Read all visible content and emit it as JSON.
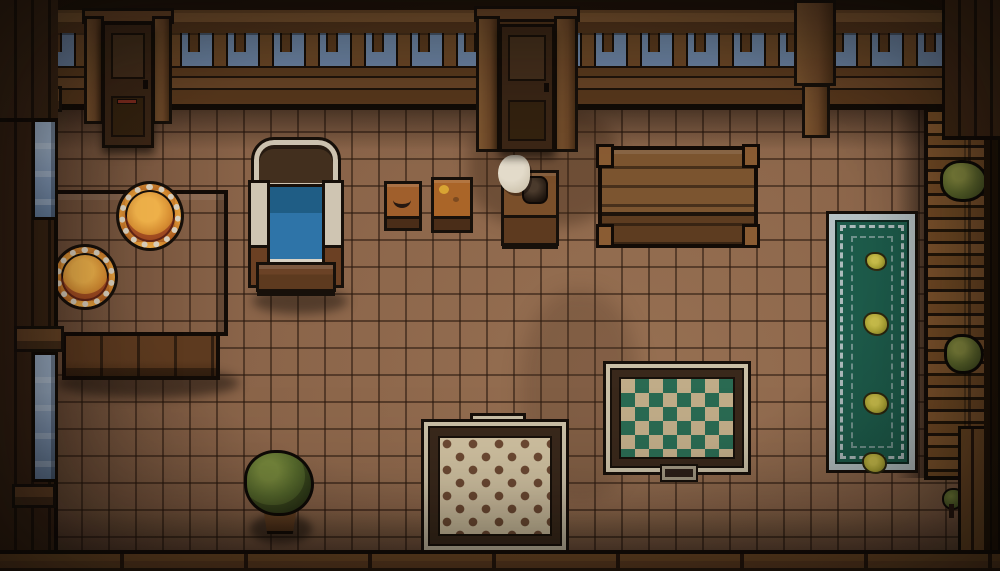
{
  "scene": {
    "title": "pixel-art top-down tavern room interior",
    "viewport": "1000x571"
  },
  "objects": {
    "door_left": {
      "label": "wooden door upper-left"
    },
    "door_center": {
      "label": "wooden door upper-center"
    },
    "bed": {
      "label": "bed with blue blanket and cream frame"
    },
    "dining_table": {
      "label": "wooden dining table"
    },
    "plate_1": {
      "label": "plate with orange food"
    },
    "plate_2": {
      "label": "plate with orange food"
    },
    "crate_1": {
      "label": "small crate table with food item"
    },
    "crate_2": {
      "label": "small crate table with food item"
    },
    "nightstand": {
      "label": "nightstand with dark jug and white cloth"
    },
    "long_table": {
      "label": "large wooden table with corner legs"
    },
    "green_rug": {
      "label": "long green runner rug with four yellow flowers"
    },
    "checkered_rug": {
      "label": "cream rug with brown checkered pattern"
    },
    "diamond_rug": {
      "label": "tan rug with green diamond pattern"
    },
    "potted_plant": {
      "label": "potted green bush"
    },
    "small_plant": {
      "label": "small plant sprite bottom-right"
    },
    "staircase": {
      "label": "wooden staircase along right wall"
    },
    "stair_bush_1": {
      "label": "bush on staircase"
    },
    "stair_bush_2": {
      "label": "bush on staircase"
    },
    "window_upper_left": {
      "label": "tall window upper left wall"
    },
    "window_lower_left": {
      "label": "tall window lower left wall"
    },
    "balustrade": {
      "label": "railing with sky visible behind"
    },
    "tile_floor": {
      "label": "brown tile floor"
    }
  },
  "palette": {
    "outline": "#17100a",
    "wall-plank": "#3a2414",
    "wall-plank-dark": "#1d120a",
    "beam": "#6b4627",
    "beam-light": "#7d5630",
    "beam-dark": "#54361c",
    "sky": "#7089aa",
    "glass": "#8ca4c6",
    "door": "#3b2616",
    "door-panel": "#46301d",
    "floor": "#8a6449",
    "table-wood": "#6e4a28",
    "plate-rim": "#d9cfbc",
    "food": "#d88f33",
    "food-dark": "#9c4a17",
    "bed-cream": "#cfc5b2",
    "bed-blue": "#2e74a8",
    "bed-blue-dark": "#1f5d85",
    "bed-wood": "#5d3a1f",
    "crate": "#a05f2c",
    "rug-green": "#1d5c4b",
    "rug-trim": "#b7c3c5",
    "flower": "#b3ab38",
    "check-base": "#cfc0a0",
    "check-dot": "#6d4a33",
    "rug-frame": "#39281b",
    "rug-cream": "#c9bfa6",
    "diamond-base": "#c0ac88",
    "diamond-green": "#2a6a52",
    "leaf": "#5a6e2e",
    "leaf-dark": "#3d4d20",
    "stair": "#7c5128",
    "stair-dark": "#241709",
    "wall-bottom": "#6b4525"
  }
}
